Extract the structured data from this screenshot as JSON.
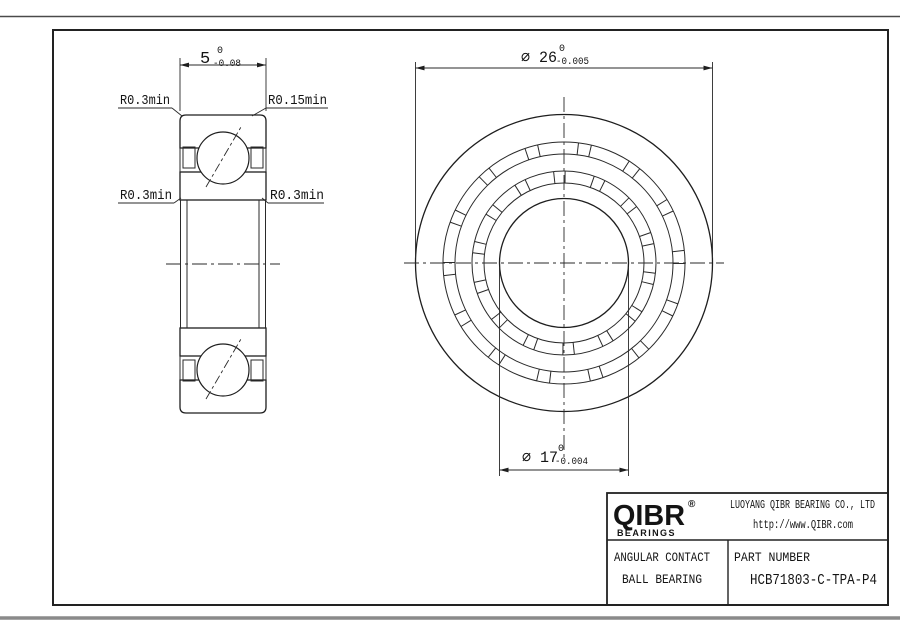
{
  "drawing": {
    "section_view": {
      "width_dim": {
        "value": "5",
        "tol_upper": "0",
        "tol_lower": "-0.08"
      },
      "radius_labels": {
        "top_left": "R0.3min",
        "top_right": "R0.15min",
        "mid_left": "R0.3min",
        "mid_right": "R0.3min"
      }
    },
    "front_view": {
      "outer_dim": {
        "value": "⌀ 26",
        "tol_upper": "0",
        "tol_lower": "-0.005"
      },
      "bore_dim": {
        "value": "⌀ 17",
        "tol_upper": "0",
        "tol_lower": "-0.004"
      }
    }
  },
  "title_block": {
    "logo": {
      "brand": "QIBR",
      "registered": "®",
      "sub": "BEARINGS"
    },
    "company": "LUOYANG QIBR BEARING CO., LTD",
    "website": "http://www.QIBR.com",
    "product_line1": "ANGULAR CONTACT",
    "product_line2": "BALL BEARING",
    "part_number_label": "PART NUMBER",
    "part_number": "HCB71803-C-TPA-P4"
  },
  "colors": {
    "line": "#1e1e1e",
    "background": "#ffffff"
  }
}
